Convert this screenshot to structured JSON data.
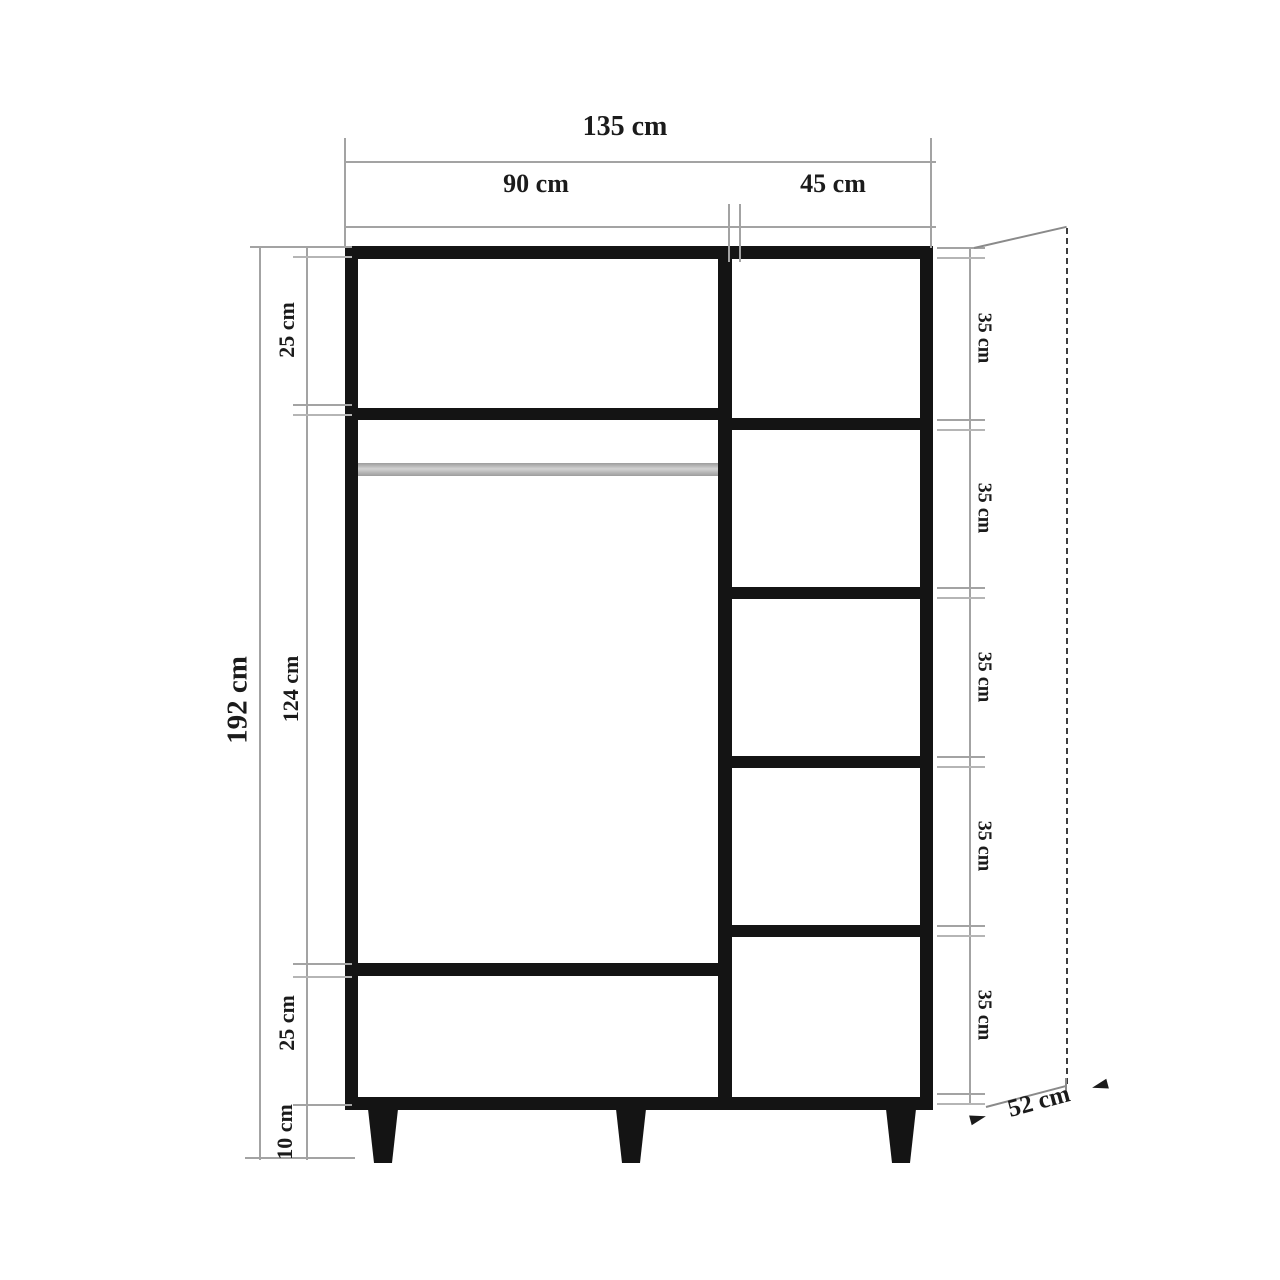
{
  "diagram": {
    "name": "wardrobe-dimension-drawing"
  },
  "dimensions": {
    "total_width": "135 cm",
    "left_section_width": "90 cm",
    "right_section_width": "45 cm",
    "total_height": "192 cm",
    "left_top_compartment_height": "25 cm",
    "left_door_height": "124 cm",
    "left_bottom_compartment_height": "25 cm",
    "leg_height": "10 cm",
    "right_compartment_heights": [
      "35 cm",
      "35 cm",
      "35 cm",
      "35 cm",
      "35 cm"
    ],
    "depth": "52 cm"
  },
  "colors": {
    "cabinet": "#141414",
    "dimension_line": "#a3a3a3",
    "dashed_depth_line": "#3c3c3c",
    "hanging_rod": "#b5b5b5",
    "text": "#1b1b1b",
    "background": "#ffffff"
  }
}
